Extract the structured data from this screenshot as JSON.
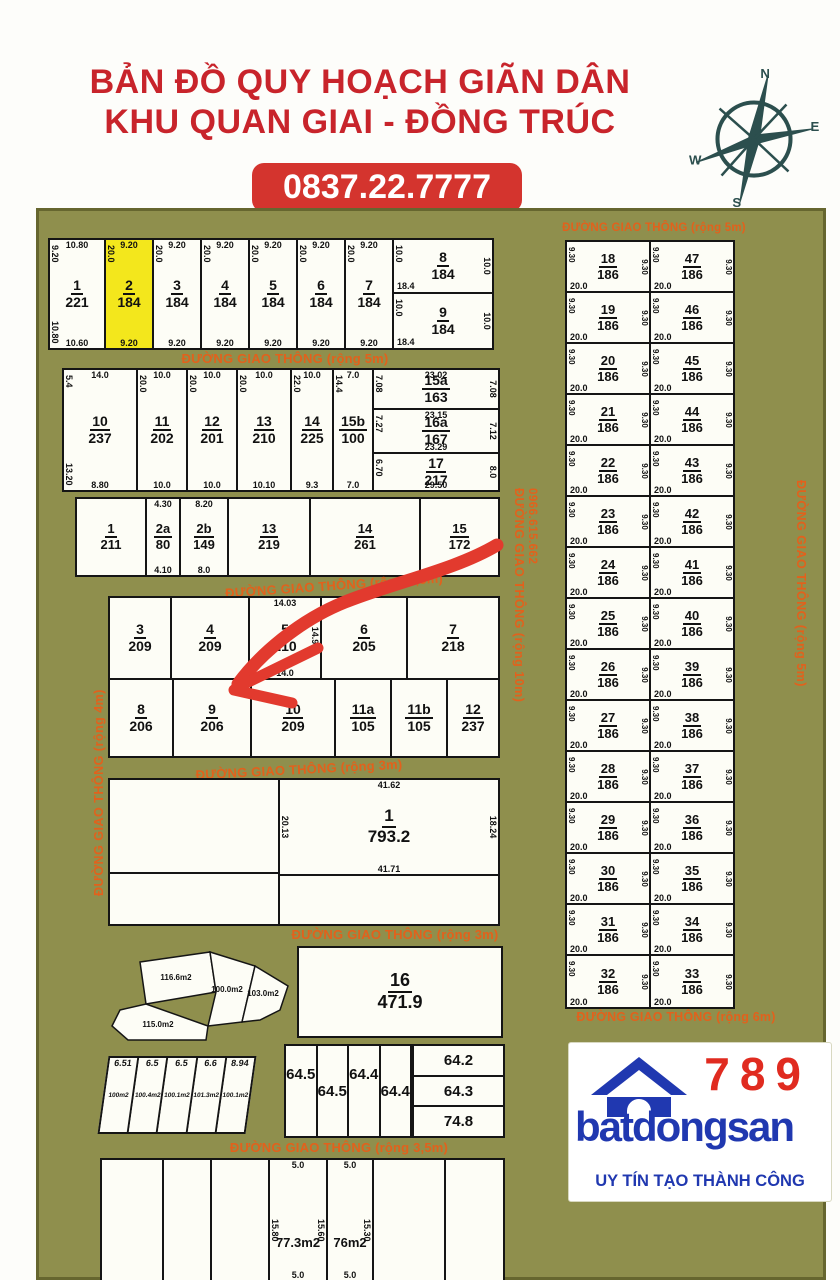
{
  "header": {
    "title1": "BẢN ĐỒ QUY HOẠCH GIÃN DÂN",
    "title2": "KHU QUAN GIAI - ĐỒNG TRÚC",
    "phone": "0837.22.7777"
  },
  "compass": {
    "n": "N",
    "e": "E",
    "s": "S",
    "w": "W"
  },
  "colors": {
    "title_red": "#c8242b",
    "badge_red": "#d4342e",
    "road_orange": "#e2611c",
    "map_olive": "#8f8f4d",
    "highlight_yellow": "#f3e71c",
    "logo_blue": "#2038b0",
    "logo_red": "#e02b20",
    "arrow_red": "#e23a2e",
    "compass_teal": "#2c4f4e"
  },
  "roads": {
    "right_top": "ĐƯỜNG GIAO THÔNG (rộng 5m)",
    "right_bottom": "ĐƯỜNG GIAO THÔNG (rộng 6m)",
    "blockA": "ĐƯỜNG GIAO THÔNG (rộng 5m)",
    "blockC": "ĐƯỜNG GIAO THÔNG (rộng 3,5m)",
    "blockD": "ĐƯỜNG GIAO THÔNG (rộng 3m)",
    "blockE": "ĐƯỜNG GIAO THÔNG (rộng 3m)",
    "blockG": "ĐƯỜNG GIAO THÔNG (rộng 3,5m)",
    "left_vertical": "ĐƯỜNG GIAO THÔNG (rộng 4m)",
    "mid_vertical": "ĐƯỜNG GIAO THÔNG (rộng 10m)",
    "mid_vertical_phone": "0966.615.662",
    "right_vertical": "ĐƯỜNG GIAO THÔNG (rộng 5m)"
  },
  "blockA": {
    "strips": [
      {
        "id": "1",
        "area": "221",
        "t": "10.80",
        "l": "9.20",
        "l2": "10.80",
        "r": "",
        "b": "10.60",
        "hl": false
      },
      {
        "id": "2",
        "area": "184",
        "t": "9.20",
        "l": "20.0",
        "l2": "",
        "r": "",
        "b": "9.20",
        "hl": true
      },
      {
        "id": "3",
        "area": "184",
        "t": "9.20",
        "l": "20.0",
        "l2": "",
        "r": "",
        "b": "9.20",
        "hl": false
      },
      {
        "id": "4",
        "area": "184",
        "t": "9.20",
        "l": "20.0",
        "l2": "",
        "r": "",
        "b": "9.20",
        "hl": false
      },
      {
        "id": "5",
        "area": "184",
        "t": "9.20",
        "l": "20.0",
        "l2": "",
        "r": "",
        "b": "9.20",
        "hl": false
      },
      {
        "id": "6",
        "area": "184",
        "t": "9.20",
        "l": "20.0",
        "l2": "",
        "r": "",
        "b": "9.20",
        "hl": false
      },
      {
        "id": "7",
        "area": "184",
        "t": "9.20",
        "l": "20.0",
        "l2": "",
        "r": "",
        "b": "9.20",
        "hl": false
      }
    ],
    "stacked": [
      {
        "id": "8",
        "area": "184",
        "t": "",
        "l": "10.0",
        "l2": "",
        "r": "10.0",
        "b": "18.4",
        "hl": false
      },
      {
        "id": "9",
        "area": "184",
        "t": "",
        "l": "10.0",
        "l2": "",
        "r": "10.0",
        "b": "18.4",
        "hl": false
      }
    ]
  },
  "blockB": {
    "strips": [
      {
        "id": "10",
        "area": "237",
        "t": "14.0",
        "l": "5.4",
        "l2": "13.20",
        "r": "",
        "b": "8.80",
        "hl": false
      },
      {
        "id": "11",
        "area": "202",
        "t": "10.0",
        "l": "20.0",
        "l2": "",
        "r": "",
        "b": "10.0",
        "hl": false
      },
      {
        "id": "12",
        "area": "201",
        "t": "10.0",
        "l": "20.0",
        "l2": "",
        "r": "",
        "b": "10.0",
        "hl": false
      },
      {
        "id": "13",
        "area": "210",
        "t": "10.0",
        "l": "20.0",
        "l2": "",
        "r": "",
        "b": "10.10",
        "hl": false
      },
      {
        "id": "14",
        "area": "225",
        "t": "10.0",
        "l": "22.0",
        "l2": "",
        "r": "",
        "b": "9.3",
        "hl": false
      },
      {
        "id": "15b",
        "area": "100",
        "t": "7.0",
        "l": "14.4",
        "l2": "",
        "r": "",
        "b": "7.0",
        "hl": false
      }
    ],
    "right": [
      {
        "id": "15a",
        "area": "163",
        "t": "23.02",
        "l": "7.08",
        "l2": "",
        "r": "7.08",
        "b": "",
        "hl": false
      },
      {
        "id": "16a",
        "area": "167",
        "t": "23.15",
        "l": "7.27",
        "l2": "",
        "r": "7.12",
        "b": "23.29",
        "hl": false
      },
      {
        "id": "17",
        "area": "217",
        "t": "",
        "l": "6.70",
        "l2": "",
        "r": "8.0",
        "b": "29.50",
        "hl": false
      }
    ]
  },
  "blockC": {
    "plots": [
      {
        "id": "1",
        "area": "211",
        "t": "",
        "l": "",
        "l2": "",
        "r": "",
        "b": "",
        "hl": false
      },
      {
        "id": "2a",
        "area": "80",
        "t": "4.30",
        "l": "",
        "l2": "",
        "r": "",
        "b": "4.10",
        "hl": false
      },
      {
        "id": "2b",
        "area": "149",
        "t": "8.20",
        "l": "",
        "l2": "",
        "r": "",
        "b": "8.0",
        "hl": false
      },
      {
        "id": "13",
        "area": "219",
        "t": "",
        "l": "",
        "l2": "",
        "r": "",
        "b": "",
        "hl": false
      },
      {
        "id": "14",
        "area": "261",
        "t": "",
        "l": "",
        "l2": "",
        "r": "",
        "b": "",
        "hl": false
      },
      {
        "id": "15",
        "area": "172",
        "t": "",
        "l": "",
        "l2": "",
        "r": "",
        "b": "",
        "hl": false
      }
    ]
  },
  "blockD": {
    "top": [
      {
        "id": "3",
        "area": "209",
        "t": "",
        "l": "",
        "l2": "",
        "r": "",
        "b": "",
        "hl": false
      },
      {
        "id": "4",
        "area": "209",
        "t": "",
        "l": "",
        "l2": "",
        "r": "",
        "b": "",
        "hl": false
      },
      {
        "id": "5",
        "area": "210",
        "t": "14.03",
        "l": "",
        "l2": "",
        "r": "14.94",
        "b": "14.0",
        "hl": false
      },
      {
        "id": "6",
        "area": "205",
        "t": "",
        "l": "",
        "l2": "",
        "r": "",
        "b": "",
        "hl": false
      },
      {
        "id": "7",
        "area": "218",
        "t": "",
        "l": "",
        "l2": "",
        "r": "",
        "b": "",
        "hl": false
      }
    ],
    "bottom": [
      {
        "id": "8",
        "area": "206",
        "t": "",
        "l": "",
        "l2": "",
        "r": "",
        "b": "",
        "hl": false
      },
      {
        "id": "9",
        "area": "206",
        "t": "",
        "l": "",
        "l2": "",
        "r": "",
        "b": "",
        "hl": false
      },
      {
        "id": "10",
        "area": "209",
        "t": "",
        "l": "",
        "l2": "",
        "r": "",
        "b": "",
        "hl": false
      },
      {
        "id": "11a",
        "area": "105",
        "t": "",
        "l": "",
        "l2": "",
        "r": "",
        "b": "",
        "hl": false
      },
      {
        "id": "11b",
        "area": "105",
        "t": "",
        "l": "",
        "l2": "",
        "r": "",
        "b": "",
        "hl": false
      },
      {
        "id": "12",
        "area": "237",
        "t": "",
        "l": "",
        "l2": "",
        "r": "",
        "b": "",
        "hl": false
      }
    ]
  },
  "blockE": {
    "plot": {
      "id": "1",
      "area": "793.2",
      "t": "41.62",
      "l": "20.13",
      "r": "18.24",
      "b": "41.71"
    }
  },
  "blockF": {
    "cluster": [
      "116.6m2",
      "100.0m2",
      "103.0m2",
      "115.0m2"
    ],
    "plot16": {
      "id": "16",
      "area": "471.9"
    }
  },
  "blockG": {
    "strips": [
      {
        "t": "6.51",
        "area": "100m2"
      },
      {
        "t": "6.5",
        "area": "100.4m2"
      },
      {
        "t": "6.5",
        "area": "100.1m2"
      },
      {
        "t": "6.6",
        "area": "101.3m2"
      },
      {
        "t": "8.94",
        "area": "100.1m2"
      }
    ],
    "m64": [
      "64.5",
      "64.5",
      "64.4",
      "64.4"
    ],
    "stack": [
      "64.2",
      "64.3",
      "74.8"
    ]
  },
  "blockH": {
    "strips": [
      {
        "t": "",
        "area": "",
        "l": "",
        "r": "",
        "b": ""
      },
      {
        "t": "",
        "area": "",
        "l": "",
        "r": "",
        "b": ""
      },
      {
        "t": "",
        "area": "",
        "l": "",
        "r": "",
        "b": ""
      },
      {
        "t": "5.0",
        "area": "77.3m2",
        "l": "15.80",
        "r": "15.60",
        "b": "5.0"
      },
      {
        "t": "5.0",
        "area": "76m2",
        "l": "",
        "r": "15.30",
        "b": "5.0"
      },
      {
        "t": "",
        "area": "",
        "l": "",
        "r": "",
        "b": ""
      },
      {
        "t": "",
        "area": "",
        "l": "",
        "r": "",
        "b": ""
      }
    ]
  },
  "right_column": {
    "side": "9.30",
    "bottom": "20.0",
    "rows": [
      {
        "l": {
          "id": "18",
          "area": "186"
        },
        "r": {
          "id": "47",
          "area": "186"
        }
      },
      {
        "l": {
          "id": "19",
          "area": "186"
        },
        "r": {
          "id": "46",
          "area": "186"
        }
      },
      {
        "l": {
          "id": "20",
          "area": "186"
        },
        "r": {
          "id": "45",
          "area": "186"
        }
      },
      {
        "l": {
          "id": "21",
          "area": "186"
        },
        "r": {
          "id": "44",
          "area": "186"
        }
      },
      {
        "l": {
          "id": "22",
          "area": "186"
        },
        "r": {
          "id": "43",
          "area": "186"
        }
      },
      {
        "l": {
          "id": "23",
          "area": "186"
        },
        "r": {
          "id": "42",
          "area": "186"
        }
      },
      {
        "l": {
          "id": "24",
          "area": "186"
        },
        "r": {
          "id": "41",
          "area": "186"
        }
      },
      {
        "l": {
          "id": "25",
          "area": "186"
        },
        "r": {
          "id": "40",
          "area": "186"
        }
      },
      {
        "l": {
          "id": "26",
          "area": "186"
        },
        "r": {
          "id": "39",
          "area": "186"
        }
      },
      {
        "l": {
          "id": "27",
          "area": "186"
        },
        "r": {
          "id": "38",
          "area": "186"
        }
      },
      {
        "l": {
          "id": "28",
          "area": "186"
        },
        "r": {
          "id": "37",
          "area": "186"
        }
      },
      {
        "l": {
          "id": "29",
          "area": "186"
        },
        "r": {
          "id": "36",
          "area": "186"
        }
      },
      {
        "l": {
          "id": "30",
          "area": "186"
        },
        "r": {
          "id": "35",
          "area": "186"
        }
      },
      {
        "l": {
          "id": "31",
          "area": "186"
        },
        "r": {
          "id": "34",
          "area": "186"
        }
      },
      {
        "l": {
          "id": "32",
          "area": "186"
        },
        "r": {
          "id": "33",
          "area": "186"
        }
      }
    ]
  },
  "logo": {
    "number": "789",
    "brand": "batdongsan",
    "slogan": "UY TÍN TẠO THÀNH CÔNG"
  }
}
